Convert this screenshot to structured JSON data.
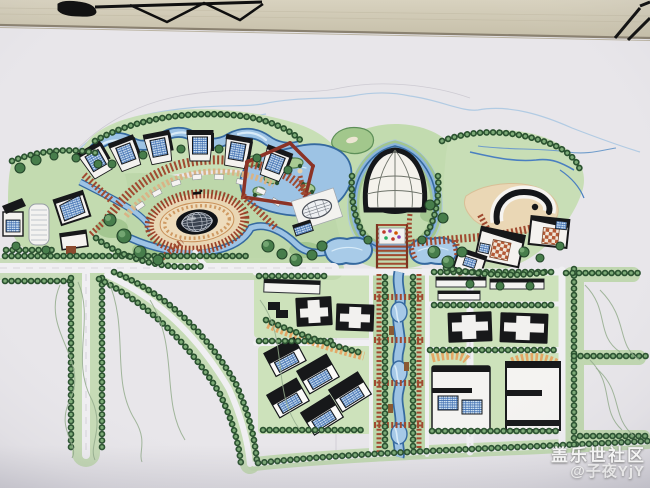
{
  "watermark": {
    "community": "盖乐世社区",
    "username": "@子夜YjY"
  },
  "palette": {
    "paper": "#e8e6ea",
    "wall": "#cfc8b3",
    "water_outline": "#35699f",
    "water_fill": "#9dc3e4",
    "green_light": "#c6deb3",
    "tree_dark": "#2b5230",
    "pergola_red": "#a04a30",
    "loop_red": "#8c3326",
    "stadium_tan": "#e9d6b4",
    "commercial_orange": "#e3a766",
    "roof_black": "#17181a",
    "solar_panel_blue": "#3e6db0",
    "courtyard_brick": "#b45a36"
  }
}
